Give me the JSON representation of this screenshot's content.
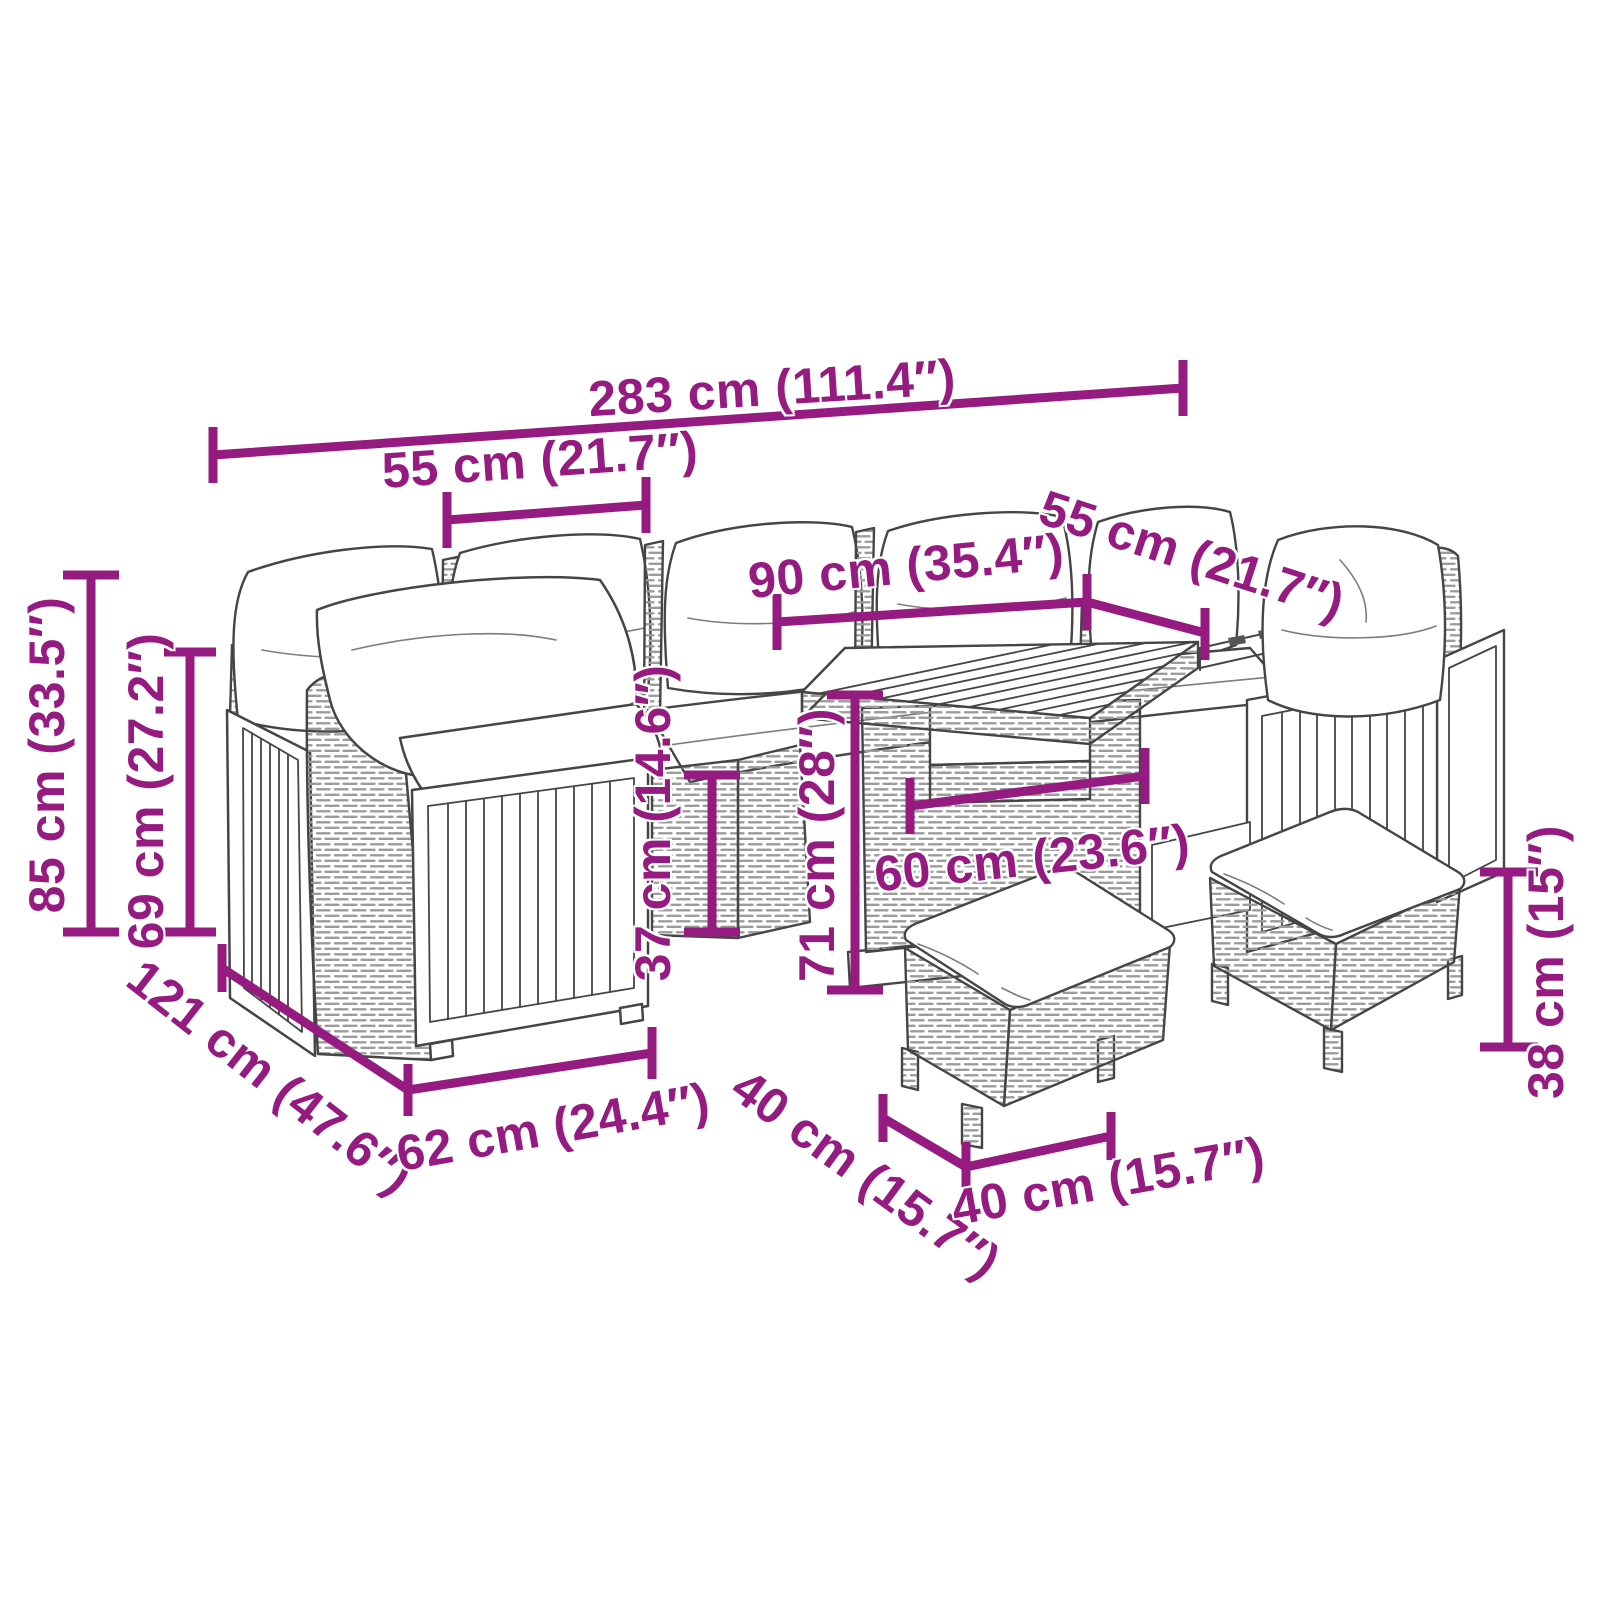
{
  "diagram": {
    "type": "product-dimension-diagram",
    "subject": "garden lounge set with sofa, table and stools",
    "accent_color": "#951B81",
    "line_color": "#454545",
    "background_color": "#ffffff",
    "dimensions": {
      "total_width": "283 cm (111.4″)",
      "module_width": "55 cm (21.7″)",
      "table_length": "90 cm (35.4″)",
      "right_module_width": "55 cm (21.7″)",
      "total_height": "85 cm (33.5″)",
      "backrest_height": "69 cm (27.2″)",
      "seat_height": "37 cm (14.6″)",
      "table_height": "71 cm (28″)",
      "table_width": "60 cm (23.6″)",
      "total_depth": "121 cm (47.6″)",
      "module_depth": "62 cm (24.4″)",
      "stool_depth": "40 cm (15.7″)",
      "stool_width": "40 cm (15.7″)",
      "stool_height": "38 cm (15″)"
    }
  }
}
